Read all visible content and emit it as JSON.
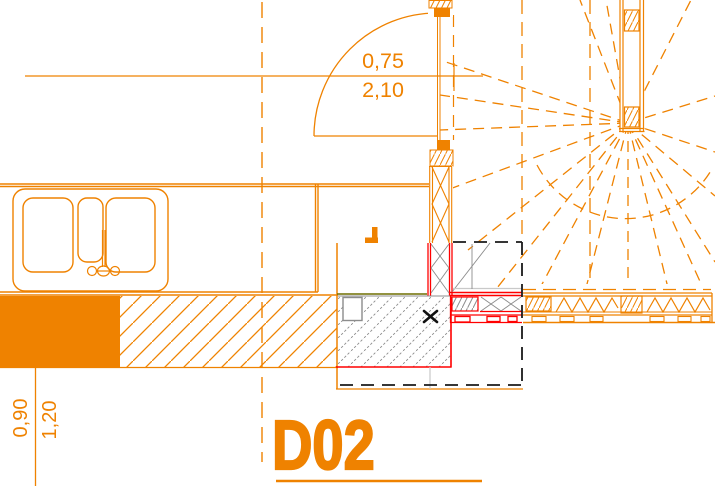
{
  "drawing": {
    "labels": {
      "detail_code": "D02",
      "dim_door_width": "0,75",
      "dim_door_height": "2,10",
      "dim_sill_height": "0,90",
      "dim_lintel_height": "1,20"
    },
    "colors": {
      "primary_orange": "#EF8200",
      "detail_red": "#FF0000",
      "hatch_gray": "#8C8C8C",
      "light_gray": "#C9C9C9",
      "finish_olive": "#6F6F00",
      "selection_black": "#1A1A1A"
    }
  }
}
